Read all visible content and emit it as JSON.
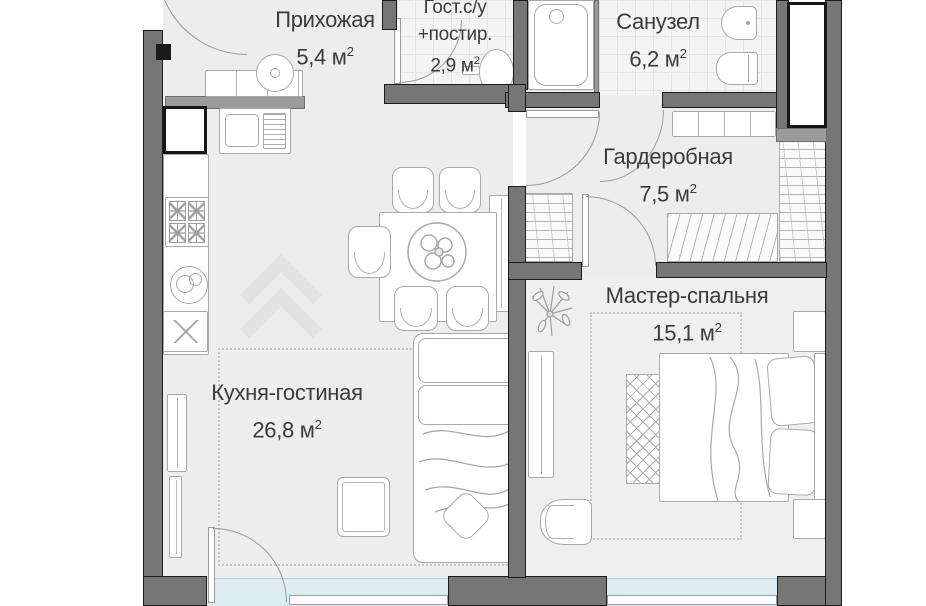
{
  "plan": {
    "type": "apartment-floor-plan",
    "area_superscript": "2",
    "rooms": [
      {
        "name": "Прихожая",
        "area": "5,4 м"
      },
      {
        "name": "Гост.с/у",
        "name_line2": "+постир.",
        "area": "2,9 м"
      },
      {
        "name": "Санузел",
        "area": "6,2 м"
      },
      {
        "name": "Гардеробная",
        "area": "7,5 м"
      },
      {
        "name": "Мастер-спальня",
        "area": "15,1 м"
      },
      {
        "name": "Кухня-гостиная",
        "area": "26,8 м"
      }
    ]
  }
}
